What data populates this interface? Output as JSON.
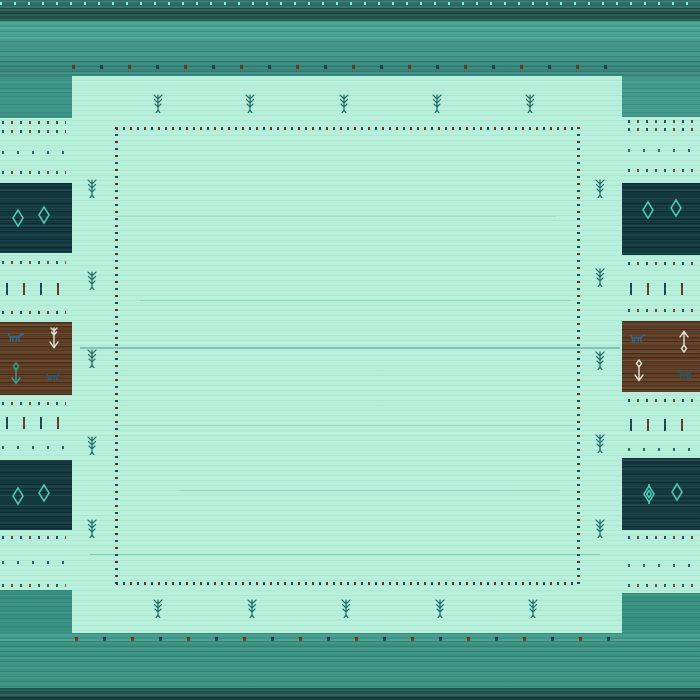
{
  "meta": {
    "subject": "gabbeh-style turquoise wool rug, square photo",
    "field_text": "",
    "notes": "no text is rendered in the image; content is woven motifs"
  },
  "palette": {
    "field_mint": "#b7efdb",
    "band_teal_light": "#46a090",
    "band_teal_mid": "#3d9486",
    "band_teal_dark": "#1f4e49",
    "band_bottom_dark": "#1e544d",
    "panel_navy": "#123840",
    "panel_brown": "#5e3b21",
    "diamond_teal": "#4fc9b8",
    "tree_teal": "#1c6560",
    "dot_red": "#6e2a16",
    "dot_navy": "#24444e",
    "cream": "#e9e6d8",
    "animal_blue": "#2c6a97"
  },
  "motifs": {
    "trees": [
      {
        "x": 152,
        "y": 93
      },
      {
        "x": 244,
        "y": 93
      },
      {
        "x": 338,
        "y": 93
      },
      {
        "x": 431,
        "y": 93
      },
      {
        "x": 524,
        "y": 93
      },
      {
        "x": 152,
        "y": 598
      },
      {
        "x": 246,
        "y": 598
      },
      {
        "x": 340,
        "y": 598
      },
      {
        "x": 434,
        "y": 598
      },
      {
        "x": 527,
        "y": 598
      },
      {
        "x": 86,
        "y": 178
      },
      {
        "x": 86,
        "y": 270
      },
      {
        "x": 86,
        "y": 348
      },
      {
        "x": 86,
        "y": 435
      },
      {
        "x": 86,
        "y": 518
      },
      {
        "x": 594,
        "y": 178
      },
      {
        "x": 594,
        "y": 267
      },
      {
        "x": 594,
        "y": 350
      },
      {
        "x": 594,
        "y": 433
      },
      {
        "x": 594,
        "y": 518
      }
    ],
    "diamonds": [
      {
        "x": 11,
        "y": 208,
        "fancy": false
      },
      {
        "x": 37,
        "y": 205,
        "fancy": false
      },
      {
        "x": 641,
        "y": 200,
        "fancy": false
      },
      {
        "x": 669,
        "y": 198,
        "fancy": false
      },
      {
        "x": 11,
        "y": 486,
        "fancy": false
      },
      {
        "x": 37,
        "y": 483,
        "fancy": false
      },
      {
        "x": 642,
        "y": 484,
        "fancy": true
      },
      {
        "x": 670,
        "y": 482,
        "fancy": false
      }
    ],
    "animals": [
      {
        "x": 8,
        "y": 332,
        "dir": "right",
        "color": "#2c6a97"
      },
      {
        "x": 46,
        "y": 371,
        "dir": "right",
        "color": "#24576f"
      },
      {
        "x": 630,
        "y": 333,
        "dir": "right",
        "color": "#2c6a97"
      },
      {
        "x": 676,
        "y": 369,
        "dir": "left",
        "color": "#24576f"
      }
    ],
    "arrows": [
      {
        "x": 48,
        "y": 326,
        "variant": "flag-down",
        "color": "#e9e6d8"
      },
      {
        "x": 10,
        "y": 362,
        "variant": "diamond-down",
        "color": "#2fa192"
      },
      {
        "x": 678,
        "y": 327,
        "variant": "diamond-up",
        "color": "#e9e6d8"
      },
      {
        "x": 633,
        "y": 359,
        "variant": "diamond-down",
        "color": "#e9e6d8"
      }
    ],
    "pattern_rows": [
      {
        "side": "left",
        "y": 121,
        "t": "a"
      },
      {
        "side": "left",
        "y": 130,
        "t": "a"
      },
      {
        "side": "left",
        "y": 151,
        "t": "s"
      },
      {
        "side": "left",
        "y": 171,
        "t": "a"
      },
      {
        "side": "left",
        "y": 261,
        "t": "a"
      },
      {
        "side": "left",
        "y": 311,
        "t": "a"
      },
      {
        "side": "left",
        "y": 402,
        "t": "a"
      },
      {
        "side": "left",
        "y": 446,
        "t": "s"
      },
      {
        "side": "left",
        "y": 536,
        "t": "a"
      },
      {
        "side": "left",
        "y": 561,
        "t": "s"
      },
      {
        "side": "left",
        "y": 584,
        "t": "a"
      },
      {
        "side": "right",
        "y": 120,
        "t": "a"
      },
      {
        "side": "right",
        "y": 128,
        "t": "a"
      },
      {
        "side": "right",
        "y": 149,
        "t": "s"
      },
      {
        "side": "right",
        "y": 169,
        "t": "a"
      },
      {
        "side": "right",
        "y": 262,
        "t": "a"
      },
      {
        "side": "right",
        "y": 309,
        "t": "a"
      },
      {
        "side": "right",
        "y": 399,
        "t": "a"
      },
      {
        "side": "right",
        "y": 448,
        "t": "s"
      },
      {
        "side": "right",
        "y": 536,
        "t": "a"
      },
      {
        "side": "right",
        "y": 564,
        "t": "s"
      },
      {
        "side": "right",
        "y": 584,
        "t": "a"
      }
    ],
    "dash_rows": [
      {
        "side": "left",
        "y": 283
      },
      {
        "side": "left",
        "y": 417
      },
      {
        "side": "right",
        "y": 283
      },
      {
        "side": "right",
        "y": 419
      }
    ],
    "streaks": [
      {
        "x": 116,
        "y": 216,
        "w": 440,
        "h": 1,
        "c": "rgba(32,150,130,0.18)"
      },
      {
        "x": 140,
        "y": 300,
        "w": 430,
        "h": 1,
        "c": "rgba(32,150,130,0.22)"
      },
      {
        "x": 80,
        "y": 347,
        "w": 540,
        "h": 2,
        "c": "rgba(20,110,95,0.33)"
      },
      {
        "x": 116,
        "y": 425,
        "w": 460,
        "h": 1,
        "c": "rgba(32,150,130,0.20)"
      },
      {
        "x": 180,
        "y": 490,
        "w": 380,
        "h": 1,
        "c": "rgba(32,150,130,0.18)"
      },
      {
        "x": 90,
        "y": 554,
        "w": 510,
        "h": 1,
        "c": "rgba(25,130,110,0.30)"
      }
    ]
  }
}
